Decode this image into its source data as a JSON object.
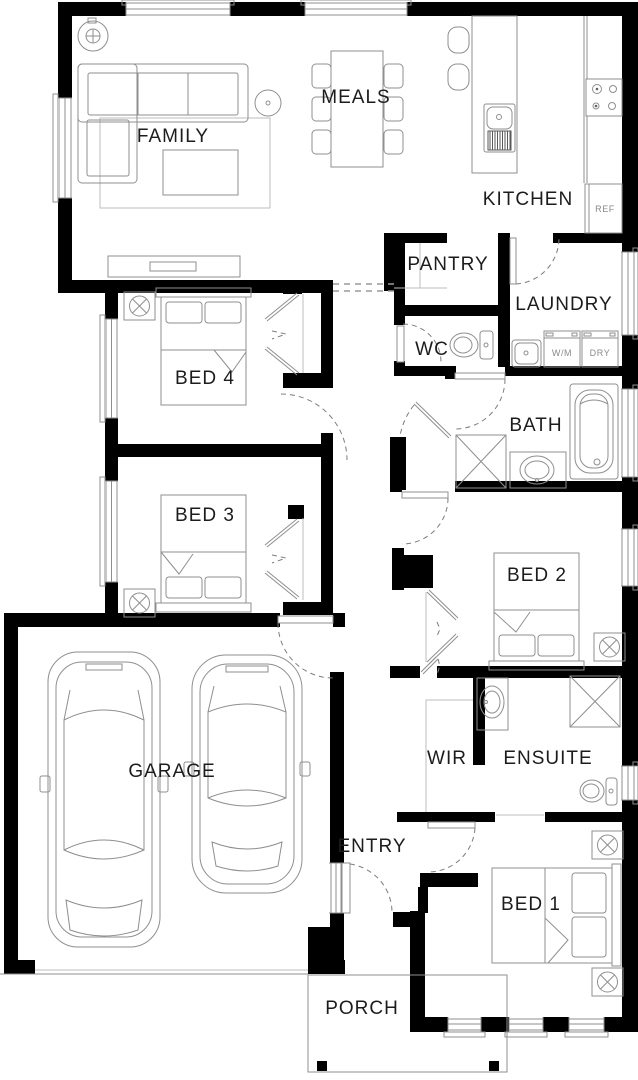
{
  "rooms": {
    "family": "FAMILY",
    "meals": "MEALS",
    "kitchen": "KITCHEN",
    "pantry": "PANTRY",
    "laundry": "LAUNDRY",
    "wc": "WC",
    "bed4": "BED 4",
    "bath": "BATH",
    "bed3": "BED 3",
    "bed2": "BED 2",
    "garage": "GARAGE",
    "wir": "WIR",
    "ensuite": "ENSUITE",
    "entry": "ENTRY",
    "bed1": "BED 1",
    "porch": "PORCH"
  },
  "appliances": {
    "washer": "W/M",
    "dryer": "DRY",
    "fridge": "REF"
  },
  "colors": {
    "wall": "#000000",
    "fixture": "#8f8f8f",
    "fixture_light": "#bdbdbd",
    "label": "#1c1c1c",
    "muted": "#8a8a8a",
    "dash": "#7d7d7d",
    "background": "#ffffff"
  }
}
